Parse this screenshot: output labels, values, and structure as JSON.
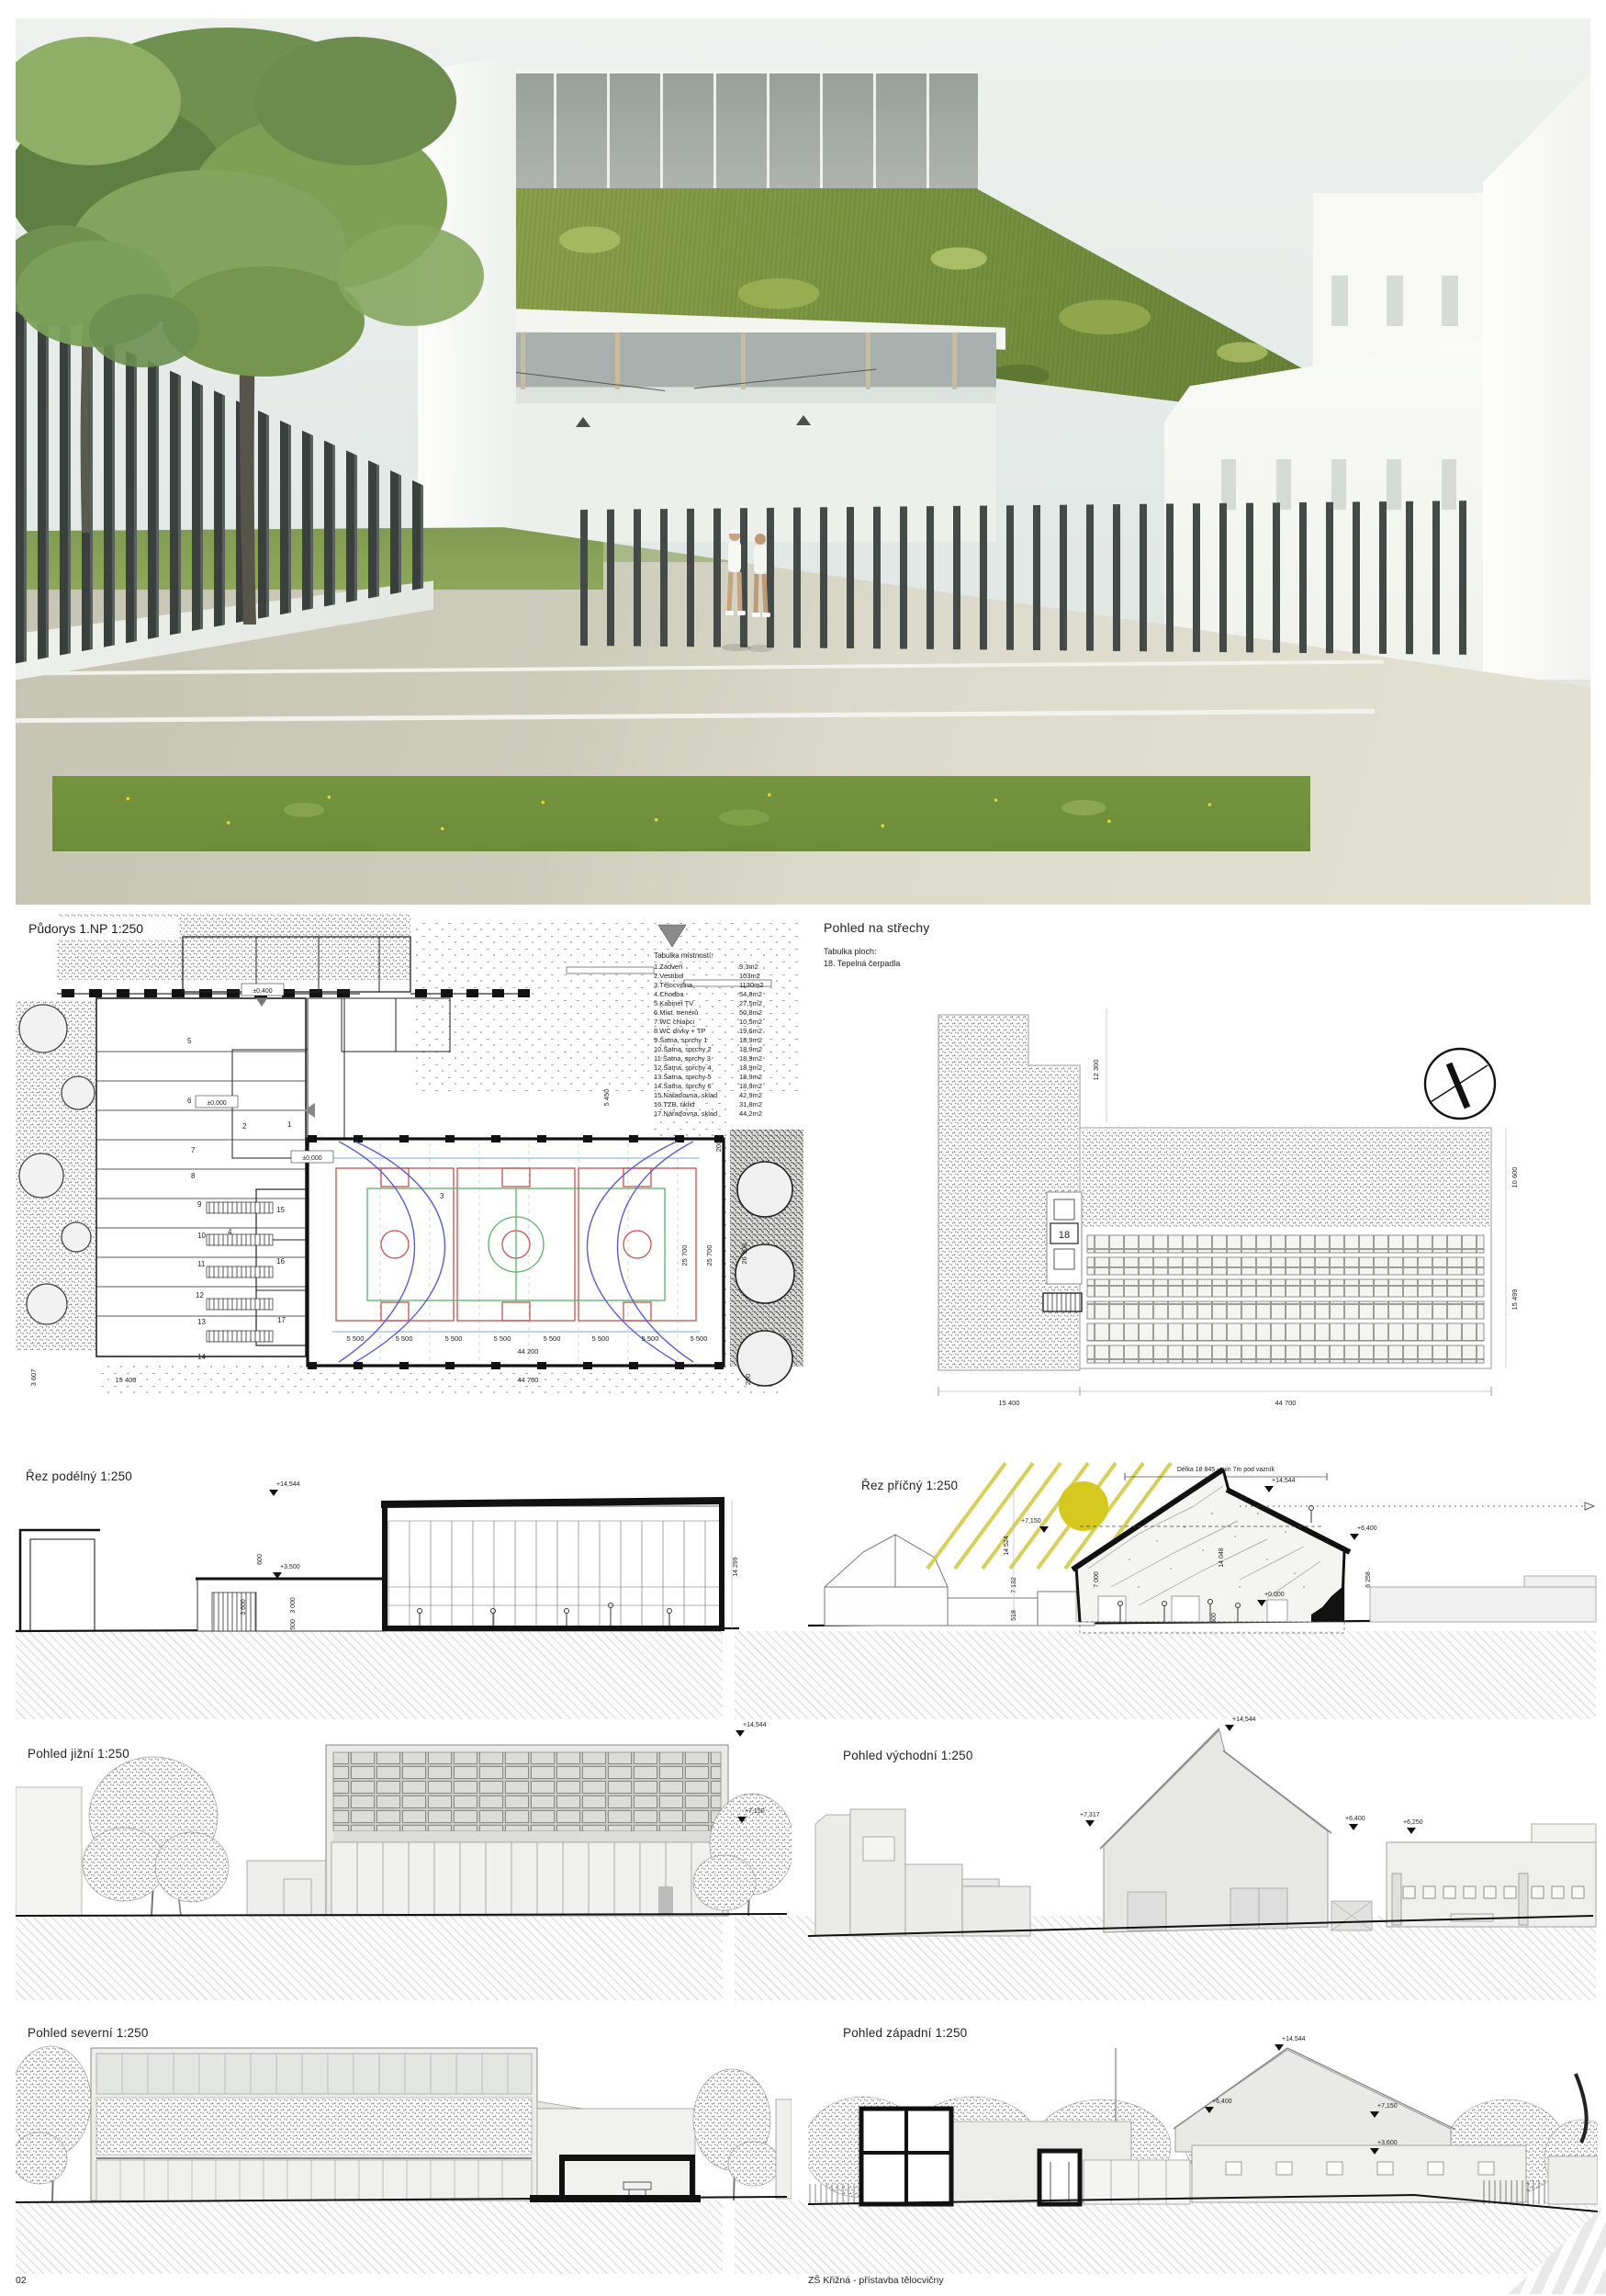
{
  "sheet": {
    "number": "02",
    "title": "ZŠ Křižná - přístavba tělocvičny"
  },
  "plan": {
    "title": "Půdorys 1.NP 1:250",
    "levels": {
      "top": "±0,400",
      "entry": "±0,000",
      "hall": "±0,000"
    },
    "table": {
      "title": "Tabulka místností:",
      "rows": [
        {
          "label": "1.Zádveří",
          "area": "9,3m2"
        },
        {
          "label": "2.Vestibul",
          "area": "103m2"
        },
        {
          "label": "3.Tělocvična",
          "area": "1130m2"
        },
        {
          "label": "4.Chodba",
          "area": "54,8m2"
        },
        {
          "label": "5.Kabinet TV",
          "area": "27,5m2"
        },
        {
          "label": "6.Míst. trenérů",
          "area": "50,8m2"
        },
        {
          "label": "7.WC chlapci",
          "area": "10,5m2"
        },
        {
          "label": "8.WC dívky + TP",
          "area": "19,6m2"
        },
        {
          "label": "9.Šatna, sprchy 1",
          "area": "18,9m2"
        },
        {
          "label": "10.Šatna, sprchy 2",
          "area": "18,9m2"
        },
        {
          "label": "11.Šatna, sprchy 3",
          "area": "18,9m2"
        },
        {
          "label": "12.Šatna, sprchy 4",
          "area": "18,9m2"
        },
        {
          "label": "13.Šatna, sprchy 5",
          "area": "18,9m2"
        },
        {
          "label": "14.Šatna, sprchy 6",
          "area": "18,9m2"
        },
        {
          "label": "15.Nářaďovna, sklad",
          "area": "42,9m2"
        },
        {
          "label": "16.TZB, úklid",
          "area": "31,8m2"
        },
        {
          "label": "17.Nářaďovna, sklad",
          "area": "44,2m2"
        }
      ]
    },
    "rooms": {
      "r1": "1",
      "r2": "2",
      "r3": "3",
      "r4": "4",
      "r5": "5",
      "r6": "6",
      "r7": "7",
      "r8": "8",
      "r9": "9",
      "r10": "10",
      "r11": "11",
      "r12": "12",
      "r13": "13",
      "r14": "14",
      "r15": "15",
      "r16": "16",
      "r17": "17"
    },
    "dims": {
      "bay": "5 500",
      "hall": "44 200",
      "left": "15 400",
      "bottom": "44 700",
      "right_a": "25 700",
      "right_b": "26 100",
      "top_right": "5 450",
      "edge": "200",
      "corner": "3 607"
    }
  },
  "roof": {
    "title": "Pohled na střechy",
    "legend_title": "Tabulka ploch:",
    "legend_item": "18. Tepelná čerpadla",
    "tag": "18",
    "dims": {
      "top": "12 300",
      "right_a": "10 600",
      "right_b": "15 499",
      "bottom_a": "15 400",
      "bottom_b": "44 700"
    }
  },
  "cut_long": {
    "title": "Řez podélný 1:250",
    "marks": {
      "a": "+14,544",
      "b": "+3,500"
    },
    "dims": {
      "a": "600",
      "b": "3 600",
      "c": "3 000",
      "d": "500",
      "e": "14 299"
    }
  },
  "cut_cross": {
    "title": "Řez příčný 1:250",
    "note": "Délka 18 845 -  min 7m pod vazník",
    "marks": {
      "a": "+14,544",
      "b": "+7,150",
      "c": "+6,400",
      "d": "+0,000"
    },
    "dims": {
      "a": "14 524",
      "b": "7 132",
      "c": "518",
      "d": "7 000",
      "e": "14 048",
      "f": "6 258",
      "g": "500"
    }
  },
  "el_s": {
    "title": "Pohled jižní 1:250",
    "marks": {
      "a": "+14,544",
      "b": "+7,150"
    }
  },
  "el_e": {
    "title": "Pohled východní 1:250",
    "marks": {
      "a": "+14,544",
      "b": "+7,317",
      "c": "+6,400",
      "d": "+6,250"
    }
  },
  "el_n": {
    "title": "Pohled severní 1:250"
  },
  "el_w": {
    "title": "Pohled západní 1:250",
    "marks": {
      "a": "+14,544",
      "b": "+6,400",
      "c": "+7,150",
      "d": "+3,600"
    }
  }
}
